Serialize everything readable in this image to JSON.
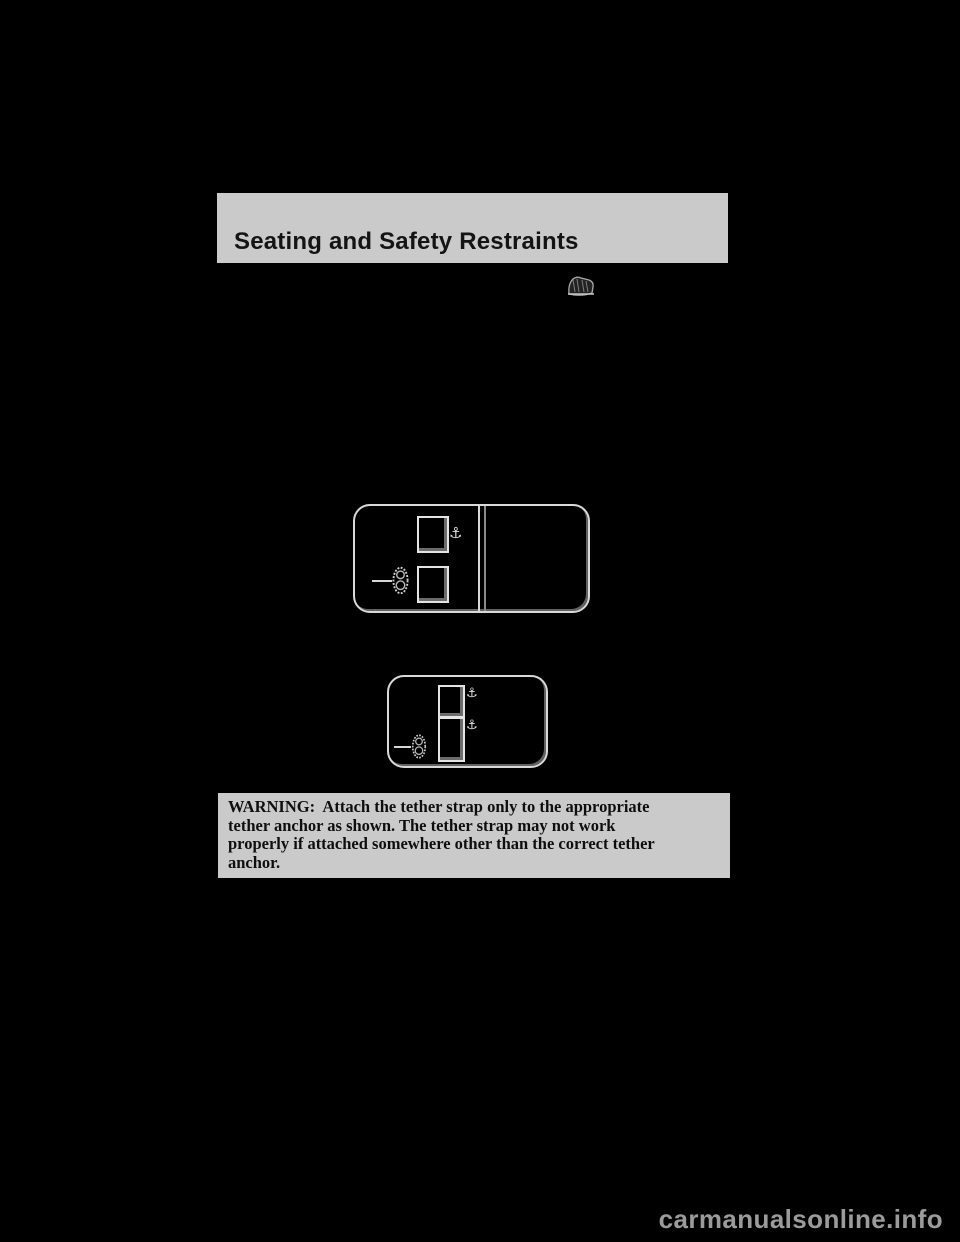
{
  "header": {
    "title": "Seating and Safety Restraints"
  },
  "symbols": {
    "anchor": "⚓"
  },
  "icons": {
    "section_icon": "child-seat-with-tether-icon",
    "tether_symbol": "tether-anchor-oval-symbol",
    "anchor_symbol": "anchor-icon"
  },
  "diagrams": {
    "upper": {
      "seat_squares": 2,
      "anchor_markers": 1,
      "has_center_divider": true
    },
    "lower": {
      "seat_squares": 2,
      "anchor_markers": 2,
      "has_center_divider": false
    }
  },
  "warning": {
    "lines": [
      "WARNING:  Attach the tether strap only to the appropriate",
      "tether anchor as shown. The tether strap may not work",
      "properly if attached somewhere other than the correct tether",
      "anchor."
    ]
  },
  "footer": {
    "watermark": "carmanualsonline.info"
  },
  "colors": {
    "page_background": "#000000",
    "panel_gray": "#cacaca",
    "line_art": "#d9d9d9",
    "watermark_gray": "#9b9b9b"
  }
}
